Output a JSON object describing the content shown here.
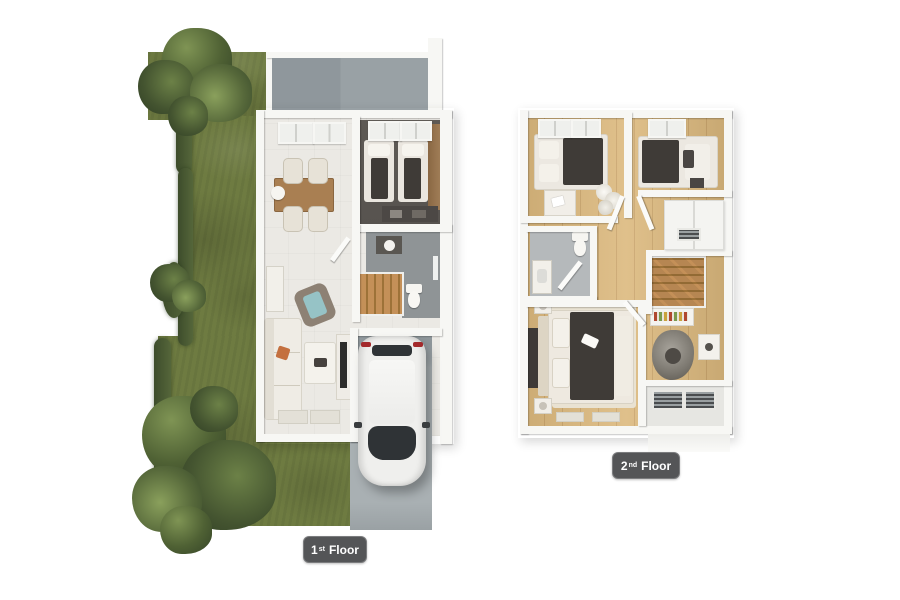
{
  "badges": {
    "floor1": {
      "number": "1",
      "ordinal": "st",
      "label": "Floor"
    },
    "floor2": {
      "number": "2",
      "ordinal": "nd",
      "label": "Floor"
    }
  },
  "colors": {
    "wall": "#f7f7f4",
    "tile": "#ebe9e4",
    "wood": "#dcb97e",
    "dark_floor": "#57534f",
    "bath_floor_1": "#8f9496",
    "bath_floor_2": "#b5b9bb",
    "concrete": "#99a1a5",
    "drive": "#a9b0b3",
    "grass": "#6e7b41",
    "hedge": "#3d4c2b",
    "label_bg": "#545557",
    "label_text": "#ffffff",
    "duvet": "#3f3b37",
    "wood_furniture": "#a97f52",
    "stair_wood": "#c49058",
    "teal_cushion": "#96c3c6",
    "car_body": "#efefed",
    "car_glass": "#2f3336",
    "car_taillight": "#a3292b",
    "rug": "#e9e2d2"
  }
}
